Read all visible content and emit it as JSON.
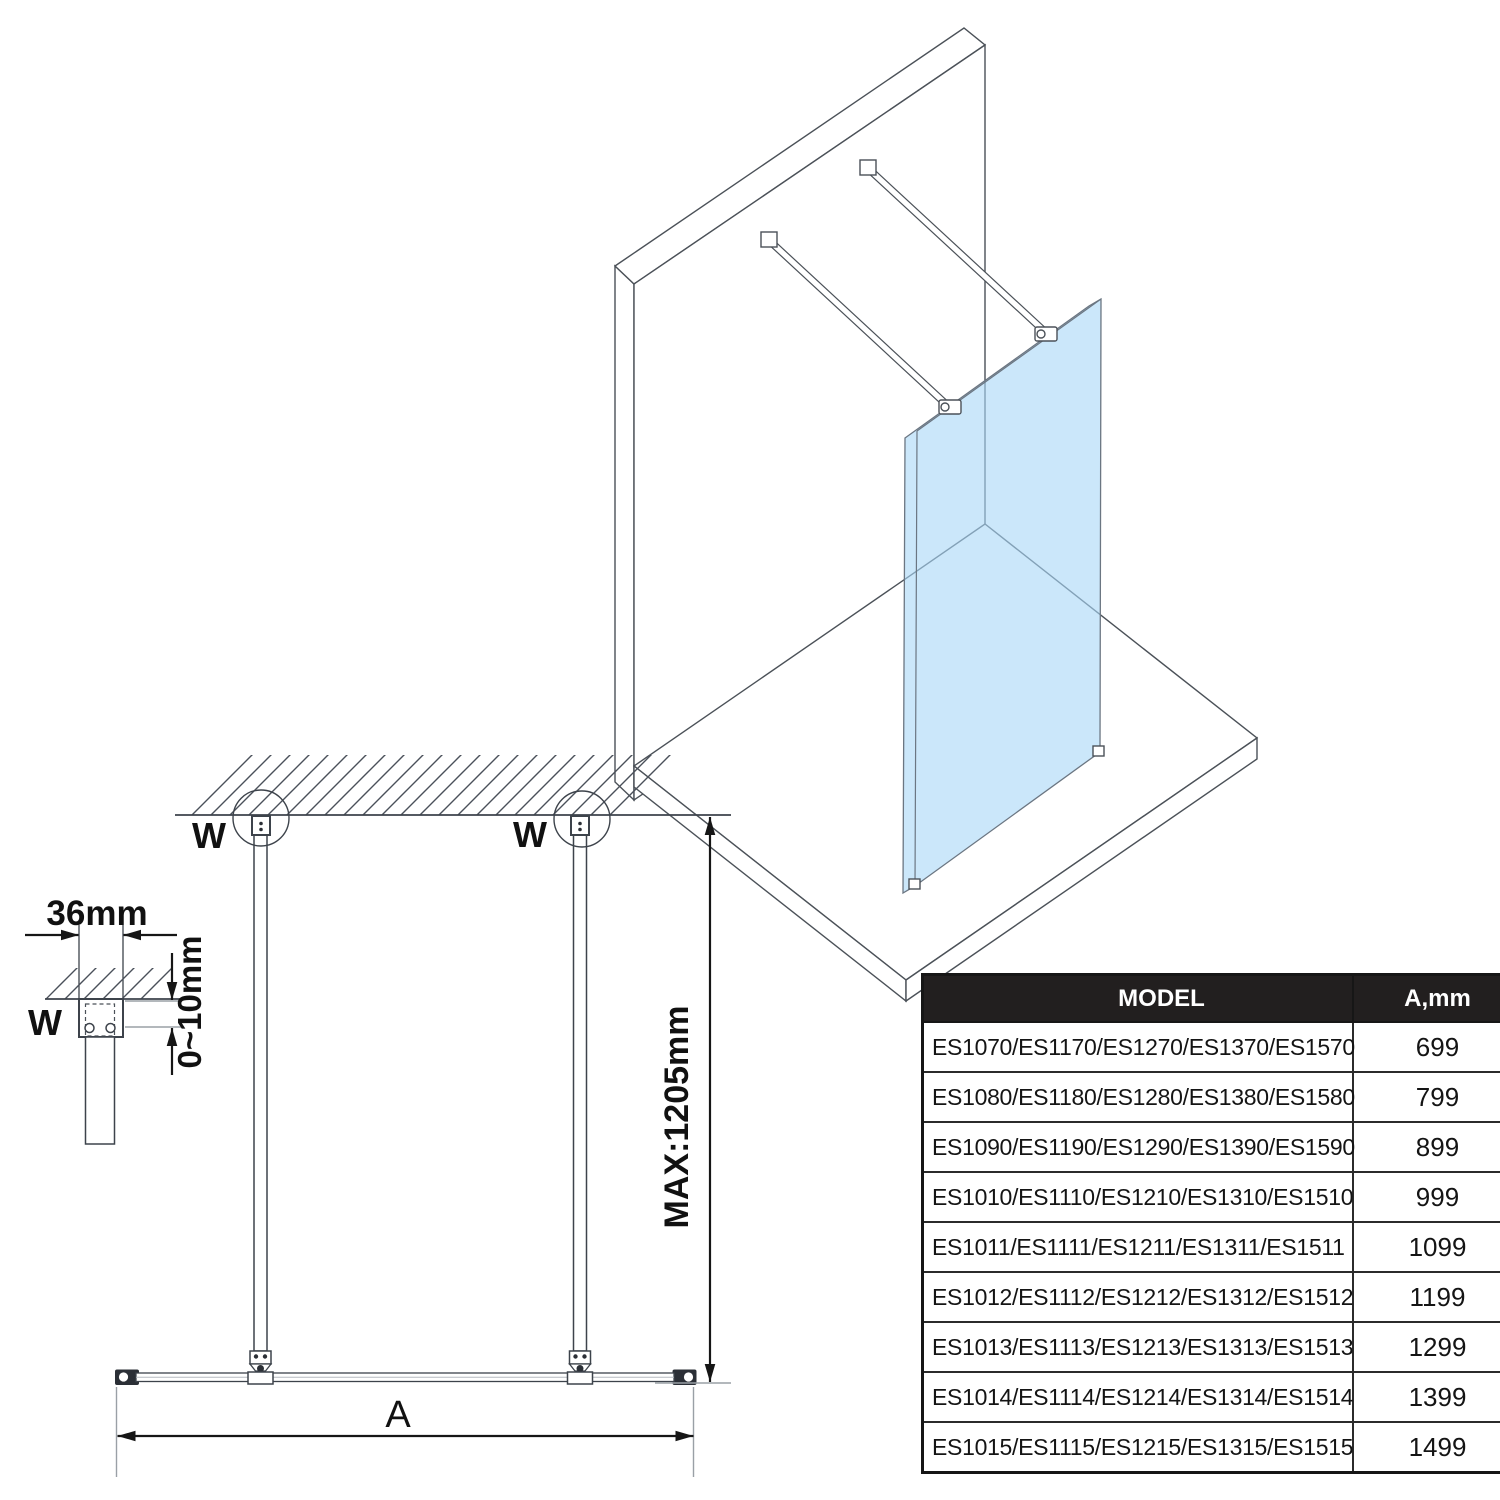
{
  "front_view": {
    "wall_marker_left": "W",
    "wall_marker_right": "W",
    "max_height_label": "MAX:1205mm",
    "width_label": "A"
  },
  "detail_view": {
    "wall_marker": "W",
    "profile_width_label": "36mm",
    "adjust_range_label": "0~10mm"
  },
  "view3d": {
    "glass_color": "#cbe7fa"
  },
  "table": {
    "header": {
      "model": "MODEL",
      "a": "A,mm"
    },
    "rows": [
      {
        "model": "ES1070/ES1170/ES1270/ES1370/ES1570",
        "a": "699"
      },
      {
        "model": "ES1080/ES1180/ES1280/ES1380/ES1580",
        "a": "799"
      },
      {
        "model": "ES1090/ES1190/ES1290/ES1390/ES1590",
        "a": "899"
      },
      {
        "model": "ES1010/ES1110/ES1210/ES1310/ES1510",
        "a": "999"
      },
      {
        "model": "ES1011/ES1111/ES1211/ES1311/ES1511",
        "a": "1099"
      },
      {
        "model": "ES1012/ES1112/ES1212/ES1312/ES1512",
        "a": "1199"
      },
      {
        "model": "ES1013/ES1113/ES1213/ES1313/ES1513",
        "a": "1299"
      },
      {
        "model": "ES1014/ES1114/ES1214/ES1314/ES1514",
        "a": "1399"
      },
      {
        "model": "ES1015/ES1115/ES1215/ES1315/ES1515",
        "a": "1499"
      }
    ]
  }
}
